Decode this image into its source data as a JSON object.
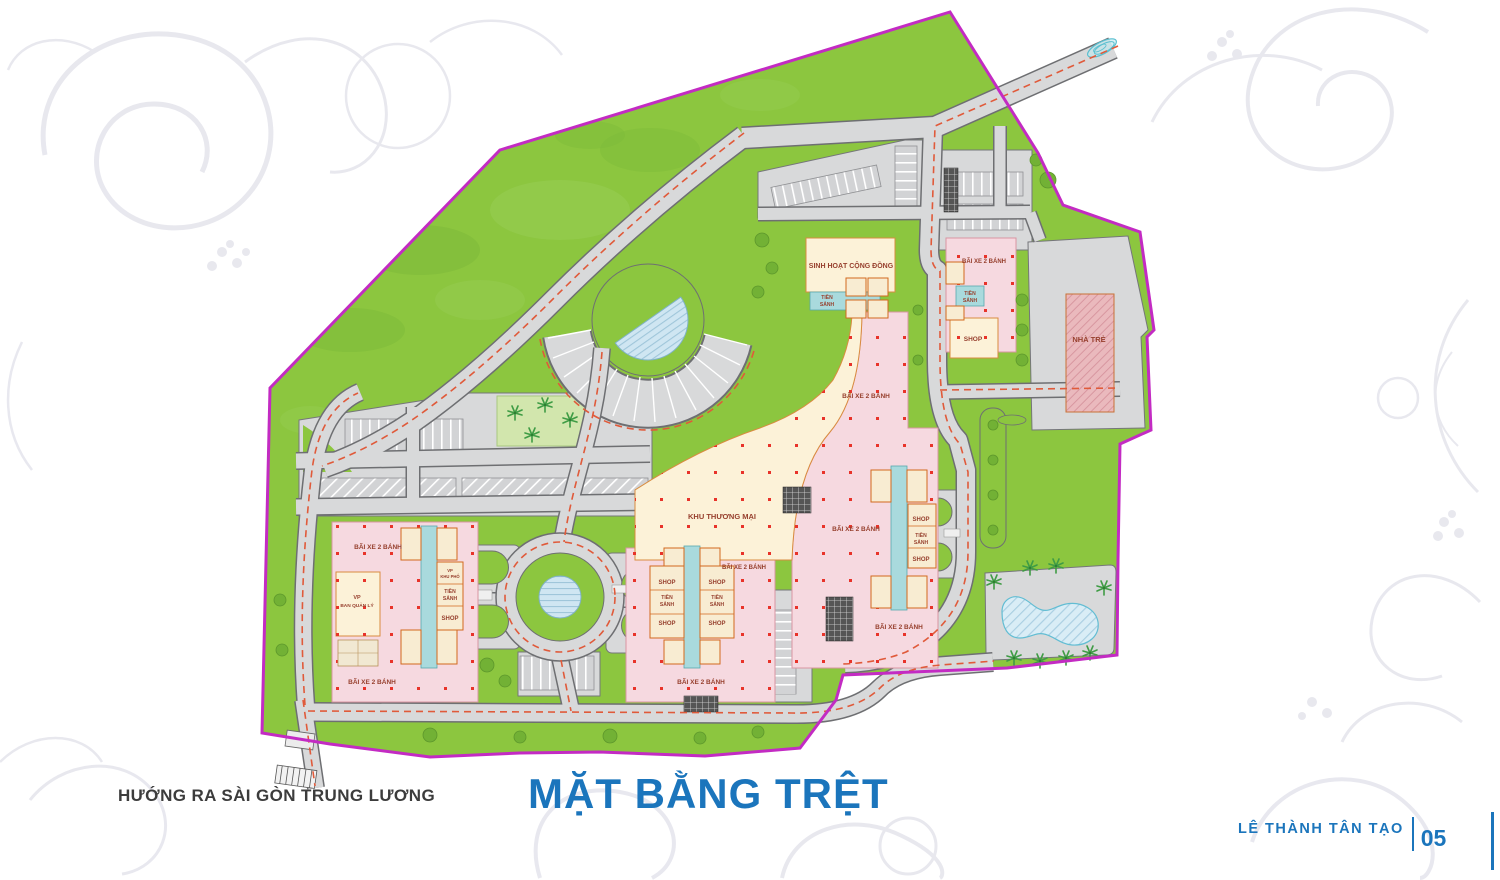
{
  "title": {
    "text": "MẶT BẰNG TRỆT"
  },
  "footer": {
    "direction_note": "HƯỚNG RA SÀI GÒN TRUNG LƯƠNG",
    "project_name": "LÊ THÀNH TÂN TẠO",
    "page_number": "05"
  },
  "colors": {
    "title_blue": "#1b75bc",
    "boundary_magenta": "#c32bc3",
    "grass_green": "#8cc63f",
    "road_gray": "#d8d9da",
    "parking_pink": "#f6d9e0",
    "commercial_cream": "#fcf2d8",
    "corridor_teal": "#a9dadd",
    "dashed_red": "#e05a3a",
    "column_dot_red": "#e8332a",
    "label_dark_red": "#97402e"
  },
  "plan": {
    "labels": [
      {
        "text": "SINH HOẠT CỘNG ĐỒNG",
        "x": 851,
        "y": 268,
        "size": 7
      },
      {
        "text": "TIỀN",
        "x": 827,
        "y": 299,
        "size": 5
      },
      {
        "text": "SẢNH",
        "x": 827,
        "y": 306,
        "size": 5
      },
      {
        "text": "BÃI XE 2 BÁNH",
        "x": 984,
        "y": 263,
        "size": 6
      },
      {
        "text": "TIỀN",
        "x": 970,
        "y": 295,
        "size": 5
      },
      {
        "text": "SẢNH",
        "x": 970,
        "y": 302,
        "size": 5
      },
      {
        "text": "SHOP",
        "x": 973,
        "y": 341,
        "size": 6.5
      },
      {
        "text": "NHÀ TRẺ",
        "x": 1089,
        "y": 342,
        "size": 7.5
      },
      {
        "text": "BÃI XE 2 BÁNH",
        "x": 866,
        "y": 398,
        "size": 6.5
      },
      {
        "text": "KHU THƯƠNG MẠI",
        "x": 722,
        "y": 519,
        "size": 7.5
      },
      {
        "text": "BÃI XE 2 BÁNH",
        "x": 856,
        "y": 531,
        "size": 6.5
      },
      {
        "text": "BÃI XE 2 BÁNH",
        "x": 744,
        "y": 569,
        "size": 6
      },
      {
        "text": "SHOP",
        "x": 921,
        "y": 521,
        "size": 6
      },
      {
        "text": "TIỀN",
        "x": 921,
        "y": 537,
        "size": 5
      },
      {
        "text": "SẢNH",
        "x": 921,
        "y": 544,
        "size": 5
      },
      {
        "text": "SHOP",
        "x": 921,
        "y": 561,
        "size": 6
      },
      {
        "text": "BÃI XE 2 BÁNH",
        "x": 899,
        "y": 629,
        "size": 6.5
      },
      {
        "text": "BÃI XE 2 BÁNH",
        "x": 378,
        "y": 549,
        "size": 6.5
      },
      {
        "text": "VP",
        "x": 357,
        "y": 599,
        "size": 5.5
      },
      {
        "text": "BAN QUẢN LÝ",
        "x": 357,
        "y": 607,
        "size": 4.8
      },
      {
        "text": "VP",
        "x": 450,
        "y": 572,
        "size": 4.2
      },
      {
        "text": "KHU PHỐ",
        "x": 450,
        "y": 578,
        "size": 4.2
      },
      {
        "text": "TIỀN",
        "x": 450,
        "y": 593,
        "size": 5
      },
      {
        "text": "SẢNH",
        "x": 450,
        "y": 600,
        "size": 5
      },
      {
        "text": "SHOP",
        "x": 450,
        "y": 620,
        "size": 6
      },
      {
        "text": "BÃI XE 2 BÁNH",
        "x": 372,
        "y": 684,
        "size": 6.5
      },
      {
        "text": "SHOP",
        "x": 667,
        "y": 584,
        "size": 6
      },
      {
        "text": "SHOP",
        "x": 717,
        "y": 584,
        "size": 6
      },
      {
        "text": "TIỀN",
        "x": 667,
        "y": 599,
        "size": 5
      },
      {
        "text": "SẢNH",
        "x": 667,
        "y": 606,
        "size": 5
      },
      {
        "text": "TIỀN",
        "x": 717,
        "y": 599,
        "size": 5
      },
      {
        "text": "SẢNH",
        "x": 717,
        "y": 606,
        "size": 5
      },
      {
        "text": "SHOP",
        "x": 667,
        "y": 625,
        "size": 6
      },
      {
        "text": "SHOP",
        "x": 717,
        "y": 625,
        "size": 6
      },
      {
        "text": "BÃI XE 2 BÁNH",
        "x": 701,
        "y": 684,
        "size": 6.5
      }
    ]
  }
}
